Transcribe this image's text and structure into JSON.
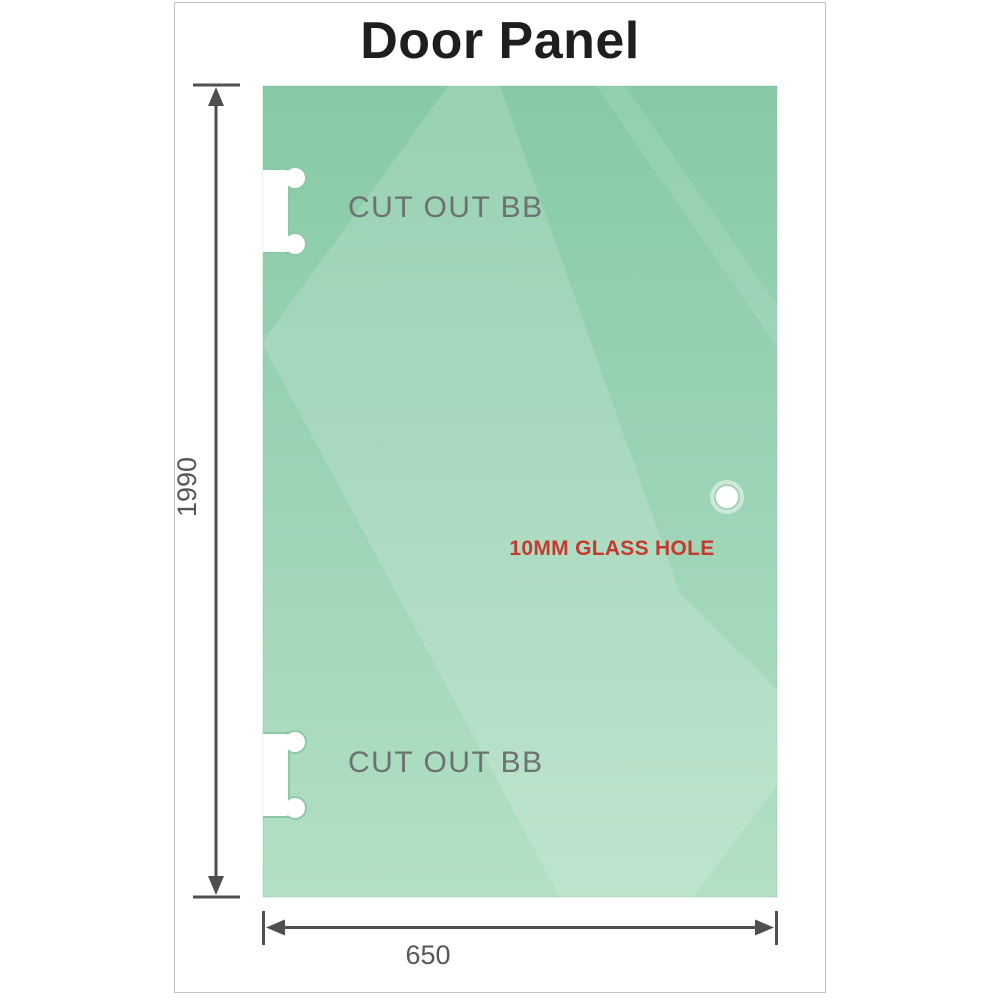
{
  "title": "Door Panel",
  "panel": {
    "cutout_top_label": "CUT OUT BB",
    "cutout_bottom_label": "CUT OUT BB",
    "hole_label": "10MM GLASS HOLE"
  },
  "dimensions": {
    "height": "1990",
    "width": "650"
  },
  "colors": {
    "glass_top": "#87caa5",
    "glass_mid": "#9cd4b6",
    "glass_bottom": "#b3e0c4",
    "hole_label_red": "#c43a2f",
    "cutout_label_gray": "#6d7172",
    "dimension_gray": "#4e4f51",
    "frame_border": "#c3c3c3"
  }
}
